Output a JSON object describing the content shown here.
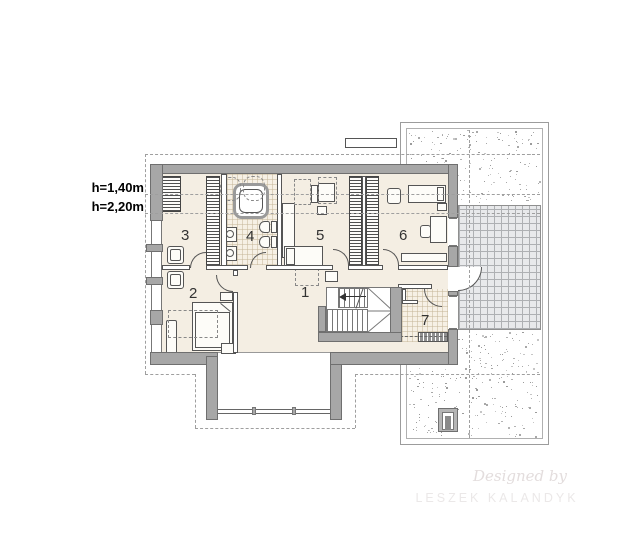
{
  "height_labels": {
    "upper": "h=1,40m",
    "lower": "h=2,20m"
  },
  "rooms": [
    {
      "number": "1"
    },
    {
      "number": "2"
    },
    {
      "number": "3"
    },
    {
      "number": "4"
    },
    {
      "number": "5"
    },
    {
      "number": "6"
    },
    {
      "number": "7"
    }
  ],
  "watermark": {
    "script": "Designed by",
    "name": "LESZEK KALANDYK"
  },
  "colors": {
    "wall": "#a7a7a7",
    "floor": "#f4eee3",
    "bath_tile": "#f6f0e5",
    "terrace_tile": "#e8e9eb",
    "dash_line": "#9f9f9f"
  }
}
